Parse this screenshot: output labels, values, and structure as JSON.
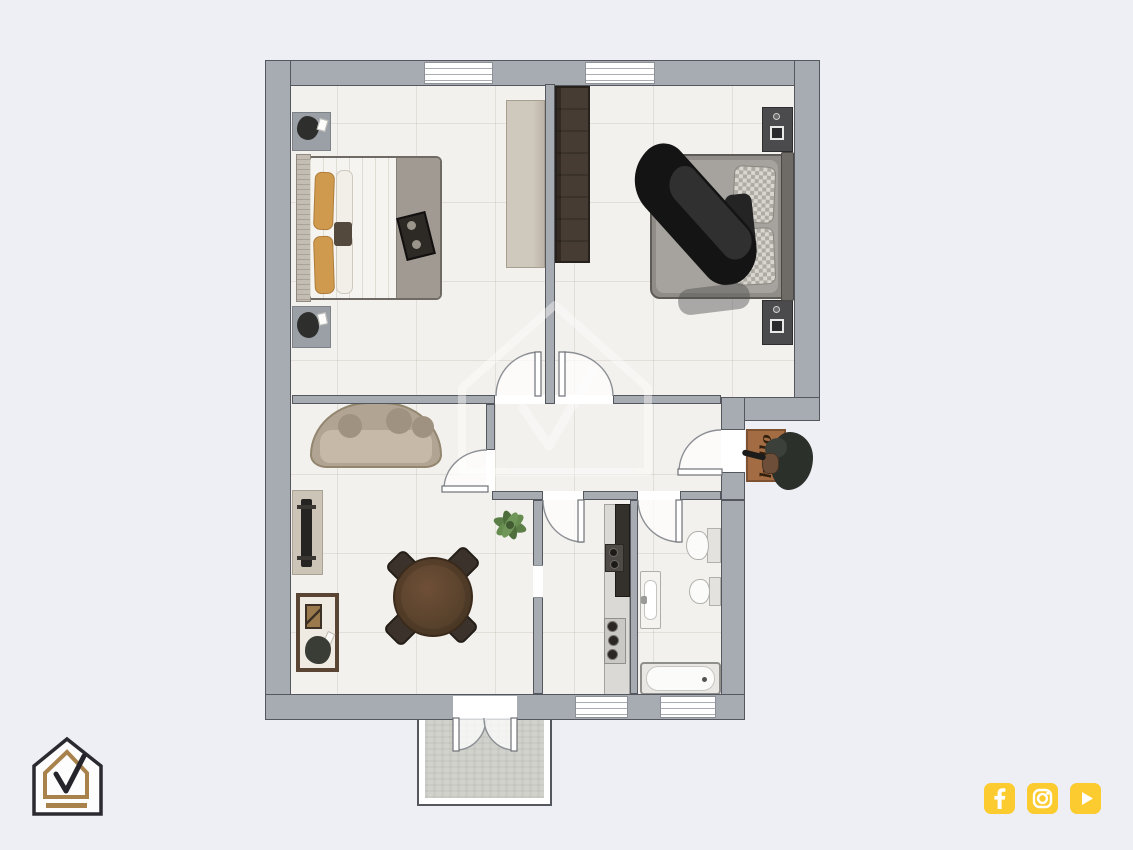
{
  "branding": {
    "logo": {
      "name": "house-check-logo",
      "outline_color": "#2b2a30",
      "accent_color": "#a8814b"
    },
    "social": {
      "color": "#fbcb2f",
      "icons": [
        {
          "name": "facebook"
        },
        {
          "name": "instagram"
        },
        {
          "name": "youtube"
        }
      ]
    }
  },
  "floorplan": {
    "doormat_text": "hello",
    "watermark": "house-check-logo",
    "colors": {
      "background": "#edeff5",
      "wall": "#a7abb2",
      "floor": "#f3f1ed",
      "terrace": "#d2d2cd",
      "doormat": "#a46c42",
      "wood_dark": "#4a4037",
      "sofa": "#b2a492",
      "accent_pillow": "#d09a4e"
    },
    "rooms": [
      {
        "id": "bedroom-1",
        "furniture": [
          "double-bed",
          "nightstand",
          "nightstand",
          "wardrobe"
        ]
      },
      {
        "id": "bedroom-2",
        "furniture": [
          "double-bed",
          "nightstand",
          "nightstand",
          "wardrobe"
        ]
      },
      {
        "id": "hallway",
        "furniture": []
      },
      {
        "id": "living-dining-room",
        "furniture": [
          "curved-sofa",
          "tv-console",
          "display-cabinet",
          "round-dining-table",
          "four-chairs",
          "plant"
        ]
      },
      {
        "id": "kitchen",
        "furniture": [
          "counter",
          "tall-cabinet",
          "cooktop",
          "oven"
        ]
      },
      {
        "id": "bathroom",
        "furniture": [
          "washbasin",
          "toilet",
          "bidet",
          "bathtub"
        ]
      },
      {
        "id": "balcony",
        "furniture": []
      },
      {
        "id": "entry",
        "furniture": [
          "doormat",
          "plant"
        ]
      }
    ]
  }
}
